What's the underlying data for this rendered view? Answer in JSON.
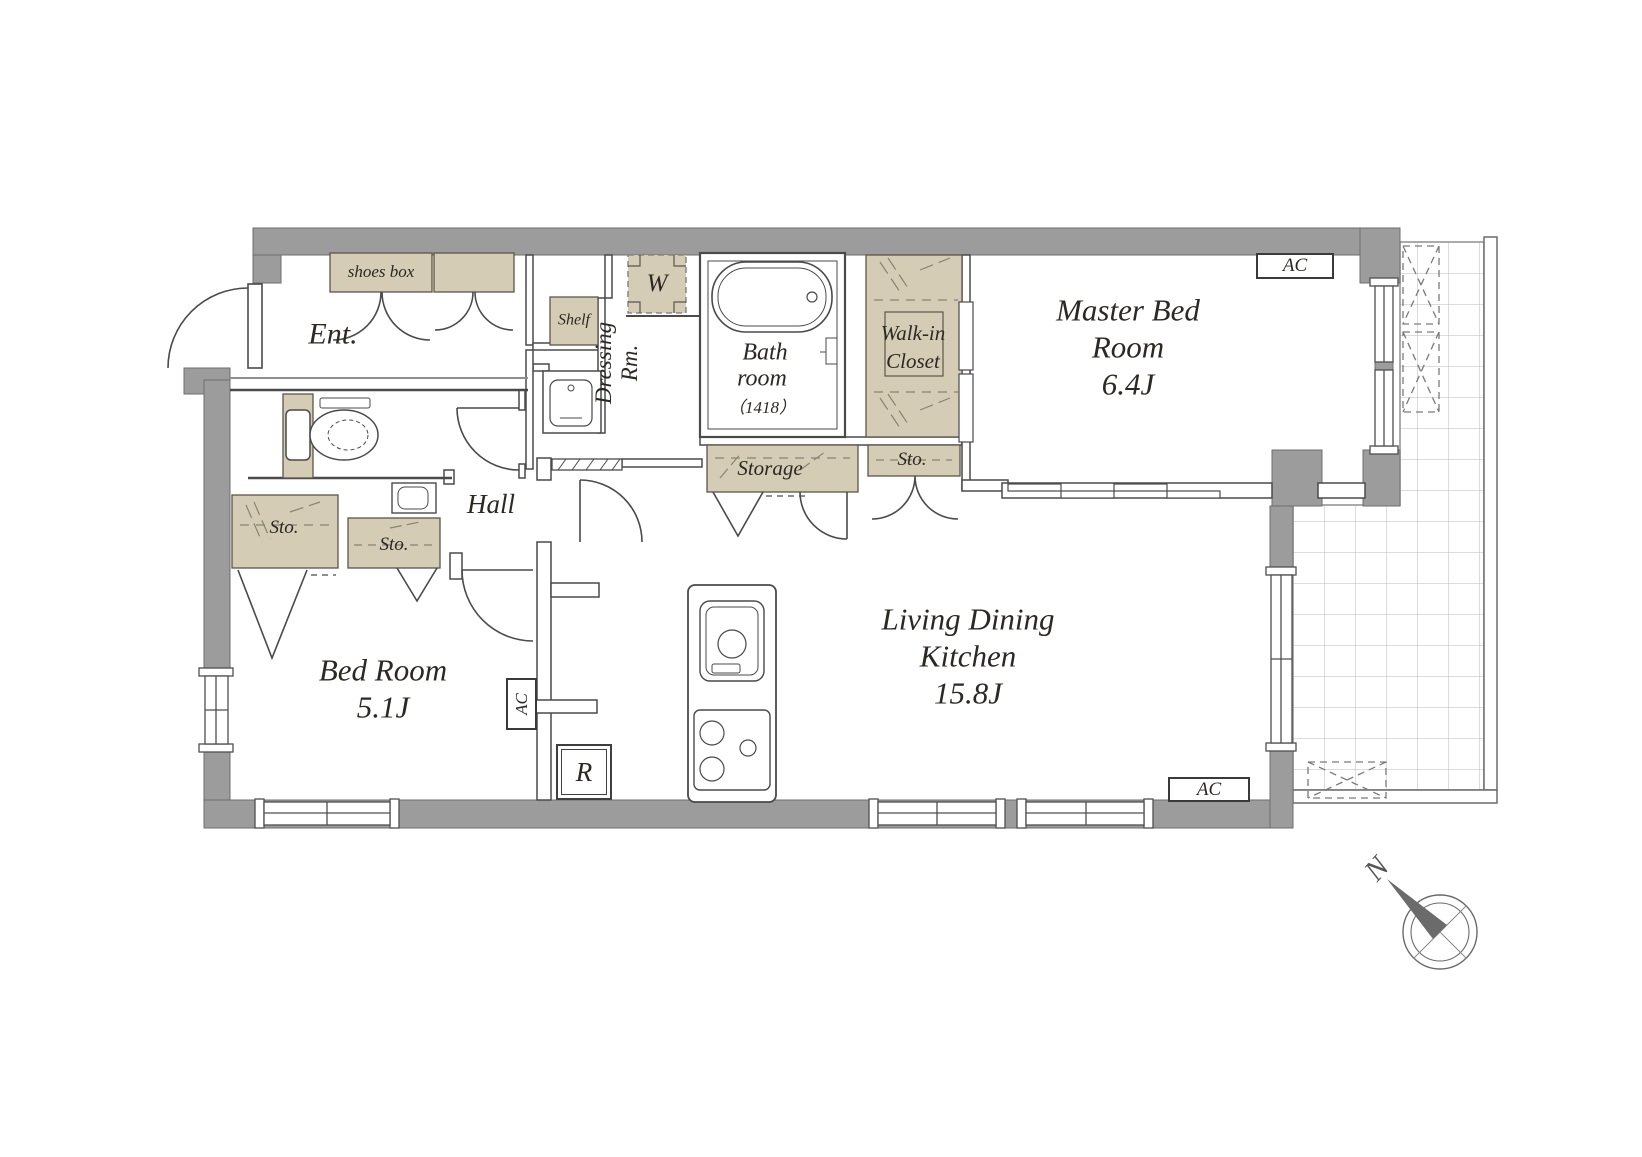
{
  "rooms": {
    "entrance": "Ent.",
    "hall": "Hall",
    "bedroom": {
      "name": "Bed Room",
      "size": "5.1J"
    },
    "master_bedroom": {
      "line1": "Master Bed",
      "line2": "Room",
      "size": "6.4J"
    },
    "ldk": {
      "line1": "Living Dining",
      "line2": "Kitchen",
      "size": "15.8J"
    },
    "bathroom": {
      "line1": "Bath",
      "line2": "room",
      "size": "（1418）"
    },
    "dressing_room": {
      "line1": "Dressing",
      "line2": "Rm."
    },
    "walk_in_closet": {
      "line1": "Walk-in",
      "line2": "Closet"
    }
  },
  "storage": {
    "shoes_box": "shoes box",
    "shelf": "Shelf",
    "storage": "Storage",
    "sto_walkin_side": "Sto.",
    "sto_bedroom_left": "Sto.",
    "sto_bedroom_right": "Sto."
  },
  "appliances": {
    "washer": "W",
    "refrigerator": "R"
  },
  "ac_labels": {
    "master_bedroom": "AC",
    "living": "AC",
    "bedroom": "AC"
  },
  "compass": {
    "north": "N"
  },
  "colors": {
    "wall": "#9c9c9c",
    "closet_fill": "#d4ccb4",
    "line": "#4a4a4a",
    "text": "#2c2824"
  }
}
